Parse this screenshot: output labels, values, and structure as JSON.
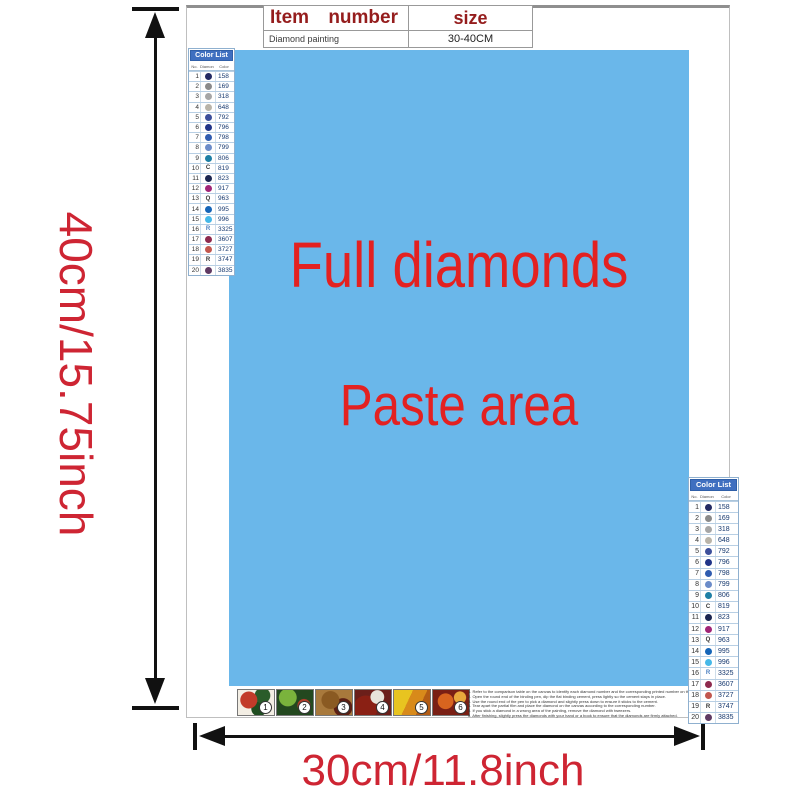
{
  "dimension_labels": {
    "height": "40cm/15.75inch",
    "width": "30cm/11.8inch"
  },
  "info_table": {
    "header": {
      "item": "Item",
      "number": "number",
      "size": "size"
    },
    "row": {
      "item": "Diamond painting",
      "size": "30-40CM"
    }
  },
  "paste_area": {
    "line1": "Full diamonds",
    "line2": "Paste area",
    "bg_color": "#6ab7ea",
    "text_color": "#e32121"
  },
  "color_list": {
    "title": "Color List",
    "columns": [
      "No.",
      "Diamond",
      "Color"
    ],
    "rows": [
      {
        "no": "1",
        "symbol": "circle",
        "color": "#232a63",
        "code": "158"
      },
      {
        "no": "2",
        "symbol": "circle",
        "color": "#8a8a8a",
        "code": "169"
      },
      {
        "no": "3",
        "symbol": "circle",
        "color": "#a6a6a6",
        "code": "318"
      },
      {
        "no": "4",
        "symbol": "circle",
        "color": "#b9b4a9",
        "code": "648"
      },
      {
        "no": "5",
        "symbol": "circle",
        "color": "#3c4f9b",
        "code": "792"
      },
      {
        "no": "6",
        "symbol": "circle",
        "color": "#203488",
        "code": "796"
      },
      {
        "no": "7",
        "symbol": "circle",
        "color": "#2f5cb0",
        "code": "798"
      },
      {
        "no": "8",
        "symbol": "circle",
        "color": "#6b8cc9",
        "code": "799"
      },
      {
        "no": "9",
        "symbol": "circle",
        "color": "#1d7fa5",
        "code": "806"
      },
      {
        "no": "10",
        "symbol": "letter",
        "letter": "C",
        "color": "#333333",
        "code": "819"
      },
      {
        "no": "11",
        "symbol": "circle",
        "color": "#1b2550",
        "code": "823"
      },
      {
        "no": "12",
        "symbol": "circle",
        "color": "#a02577",
        "code": "917"
      },
      {
        "no": "13",
        "symbol": "letter",
        "letter": "Q",
        "color": "#333333",
        "code": "963"
      },
      {
        "no": "14",
        "symbol": "circle",
        "color": "#1565b8",
        "code": "995"
      },
      {
        "no": "15",
        "symbol": "circle",
        "color": "#45b8e8",
        "code": "996"
      },
      {
        "no": "16",
        "symbol": "letter",
        "letter": "R",
        "color": "#4a7fc0",
        "code": "3325"
      },
      {
        "no": "17",
        "symbol": "circle",
        "color": "#8e2a4e",
        "code": "3607"
      },
      {
        "no": "18",
        "symbol": "circle",
        "color": "#c2574e",
        "code": "3727"
      },
      {
        "no": "19",
        "symbol": "letter",
        "letter": "R",
        "color": "#333333",
        "code": "3747"
      },
      {
        "no": "20",
        "symbol": "circle",
        "color": "#5f3a63",
        "code": "3835"
      }
    ]
  },
  "steps": {
    "numbers": [
      "1",
      "2",
      "3",
      "4",
      "5",
      "6"
    ],
    "instructions": [
      "Refer to the comparison table on the canvas to identify each diamond number and the corresponding printed number on the canvas.",
      "Open the round end of the binding pen, dip the flat binding cement, press lightly so the cement stays in place.",
      "Use the round end of the pen to pick a diamond and slightly press down to ensure it sticks to the cement.",
      "Tear apart the partial film and place the diamond on the canvas according to the corresponding number.",
      "If you stick a diamond in a wrong area of the painting, remove the diamond with tweezers.",
      "After finishing, slightly press the diamonds with your hand or a book to ensure that the diamonds are firmly attached."
    ]
  }
}
